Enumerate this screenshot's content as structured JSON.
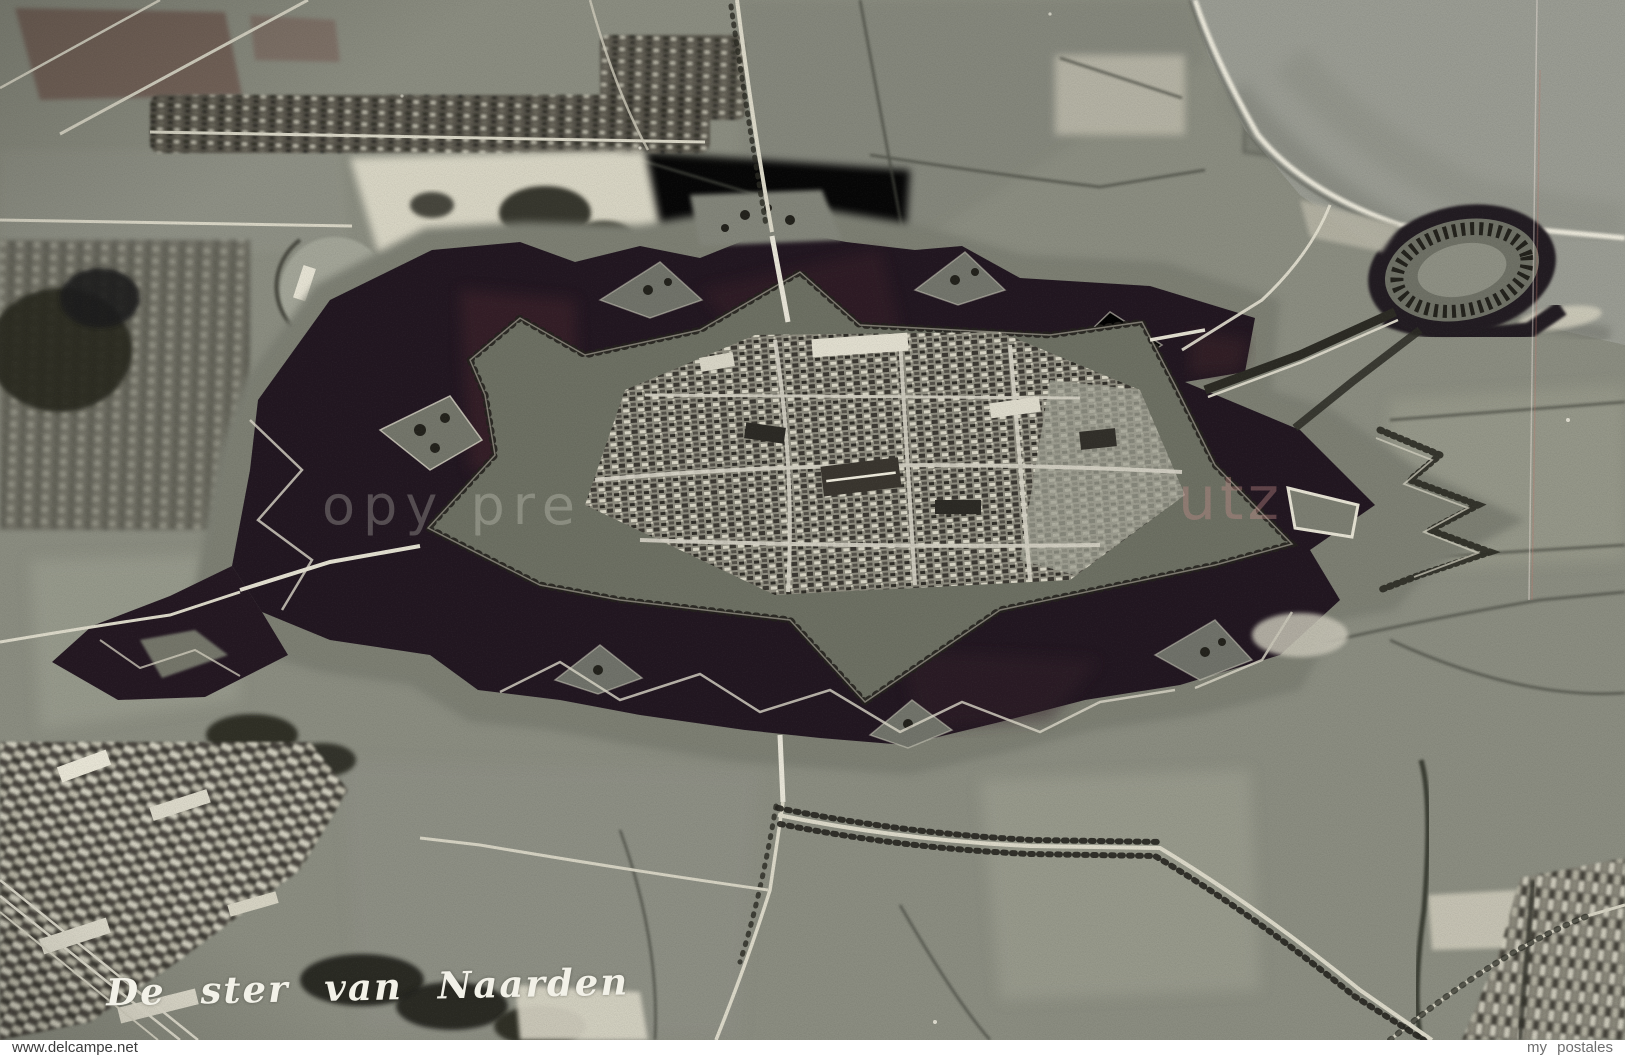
{
  "postcard": {
    "caption": "De ster van Naarden",
    "watermarks": {
      "left_fragment": "opy pre",
      "right_fragment": "utz"
    },
    "footer": {
      "left": "www.delcampe.net",
      "right": "my postales"
    },
    "photo": {
      "subject": "Black-and-white aerial photograph of the star-shaped fortress town of Naarden surrounded by its dark moat, with Fort Ronduit and the sea dike at top right, fields, tree-lined roads and allotments around"
    },
    "colors": {
      "field_gray": "#8b8d81",
      "moat_water_dark": "#221721",
      "moat_water_maroon": "#46282f",
      "road_light": "#dcd9c9",
      "tree_dark": "#26261f",
      "sea_gray": "#9a9c93",
      "dike_white": "#ece9db",
      "caption_white": "#f2f1e8",
      "footer_bg": "#ffffff",
      "footer_left_text": "#3c3c3c",
      "footer_right_text": "#6e6e6e"
    }
  }
}
